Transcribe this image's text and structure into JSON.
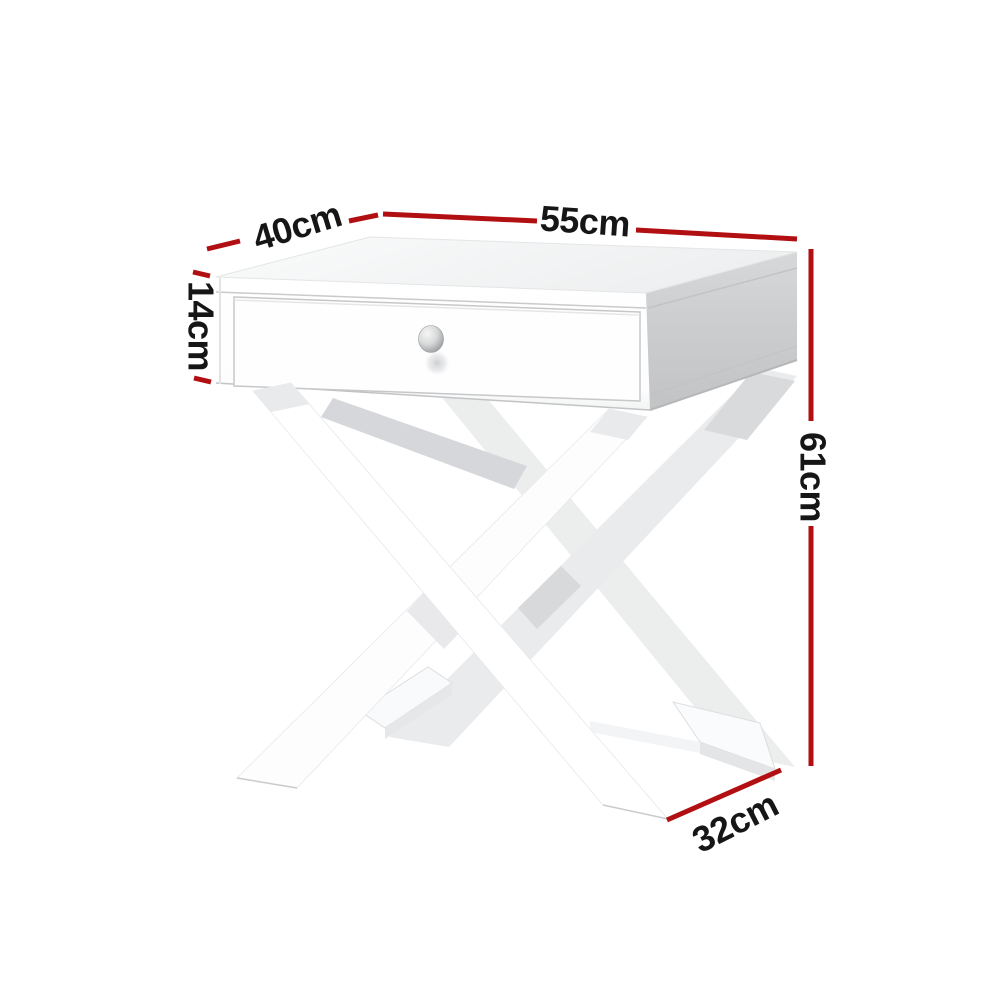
{
  "page": {
    "type": "product dimension diagram",
    "background": "#ffffff"
  },
  "product": {
    "name": "White X-frame bedside side table with single drawer",
    "knob": "silver-round-knob"
  },
  "annotations": {
    "accent_color": "#b10f12",
    "text_color": "#161616",
    "labels": {
      "top_depth": "40cm",
      "top_width": "55cm",
      "drawer_height": "14cm",
      "total_height": "61cm",
      "foot_depth": "32cm"
    }
  }
}
